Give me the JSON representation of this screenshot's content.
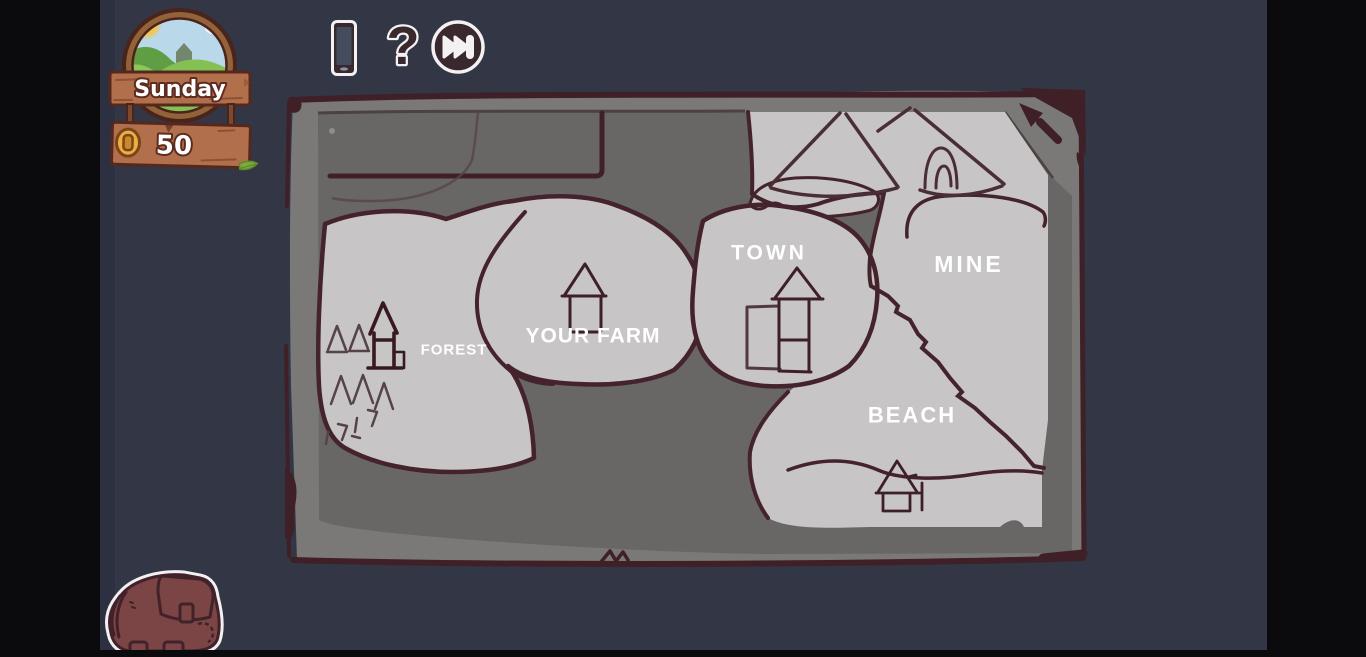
{
  "hud": {
    "day": "Sunday",
    "money": "50"
  },
  "toolbar": {
    "help_label": "?"
  },
  "map": {
    "regions": [
      {
        "id": "forest",
        "label": "FOREST"
      },
      {
        "id": "your_farm",
        "label": "YOUR FARM"
      },
      {
        "id": "town",
        "label": "TOWN"
      },
      {
        "id": "mine",
        "label": "MINE"
      },
      {
        "id": "beach",
        "label": "BEACH"
      }
    ]
  },
  "icons": {
    "tablet": "tablet-icon",
    "help": "help-icon",
    "skip": "skip-forward-icon",
    "backpack": "backpack-icon",
    "coin": "coin-icon",
    "day_window": "landscape-window-icon",
    "north_arrow": "north-arrow-icon",
    "leaf": "leaf-icon"
  },
  "colors": {
    "background": "#333645",
    "letterbox": "#0b0b0d",
    "map_parchment": "#7b7878",
    "map_interior": "#696666",
    "map_region": "#c7c5c5",
    "map_line": "#44232c",
    "wood": "#b26f4b",
    "wood_border": "#55281e",
    "coin_gold": "#efae44",
    "icon_maroon": "#3a282f",
    "label_text": "#ffffff"
  }
}
